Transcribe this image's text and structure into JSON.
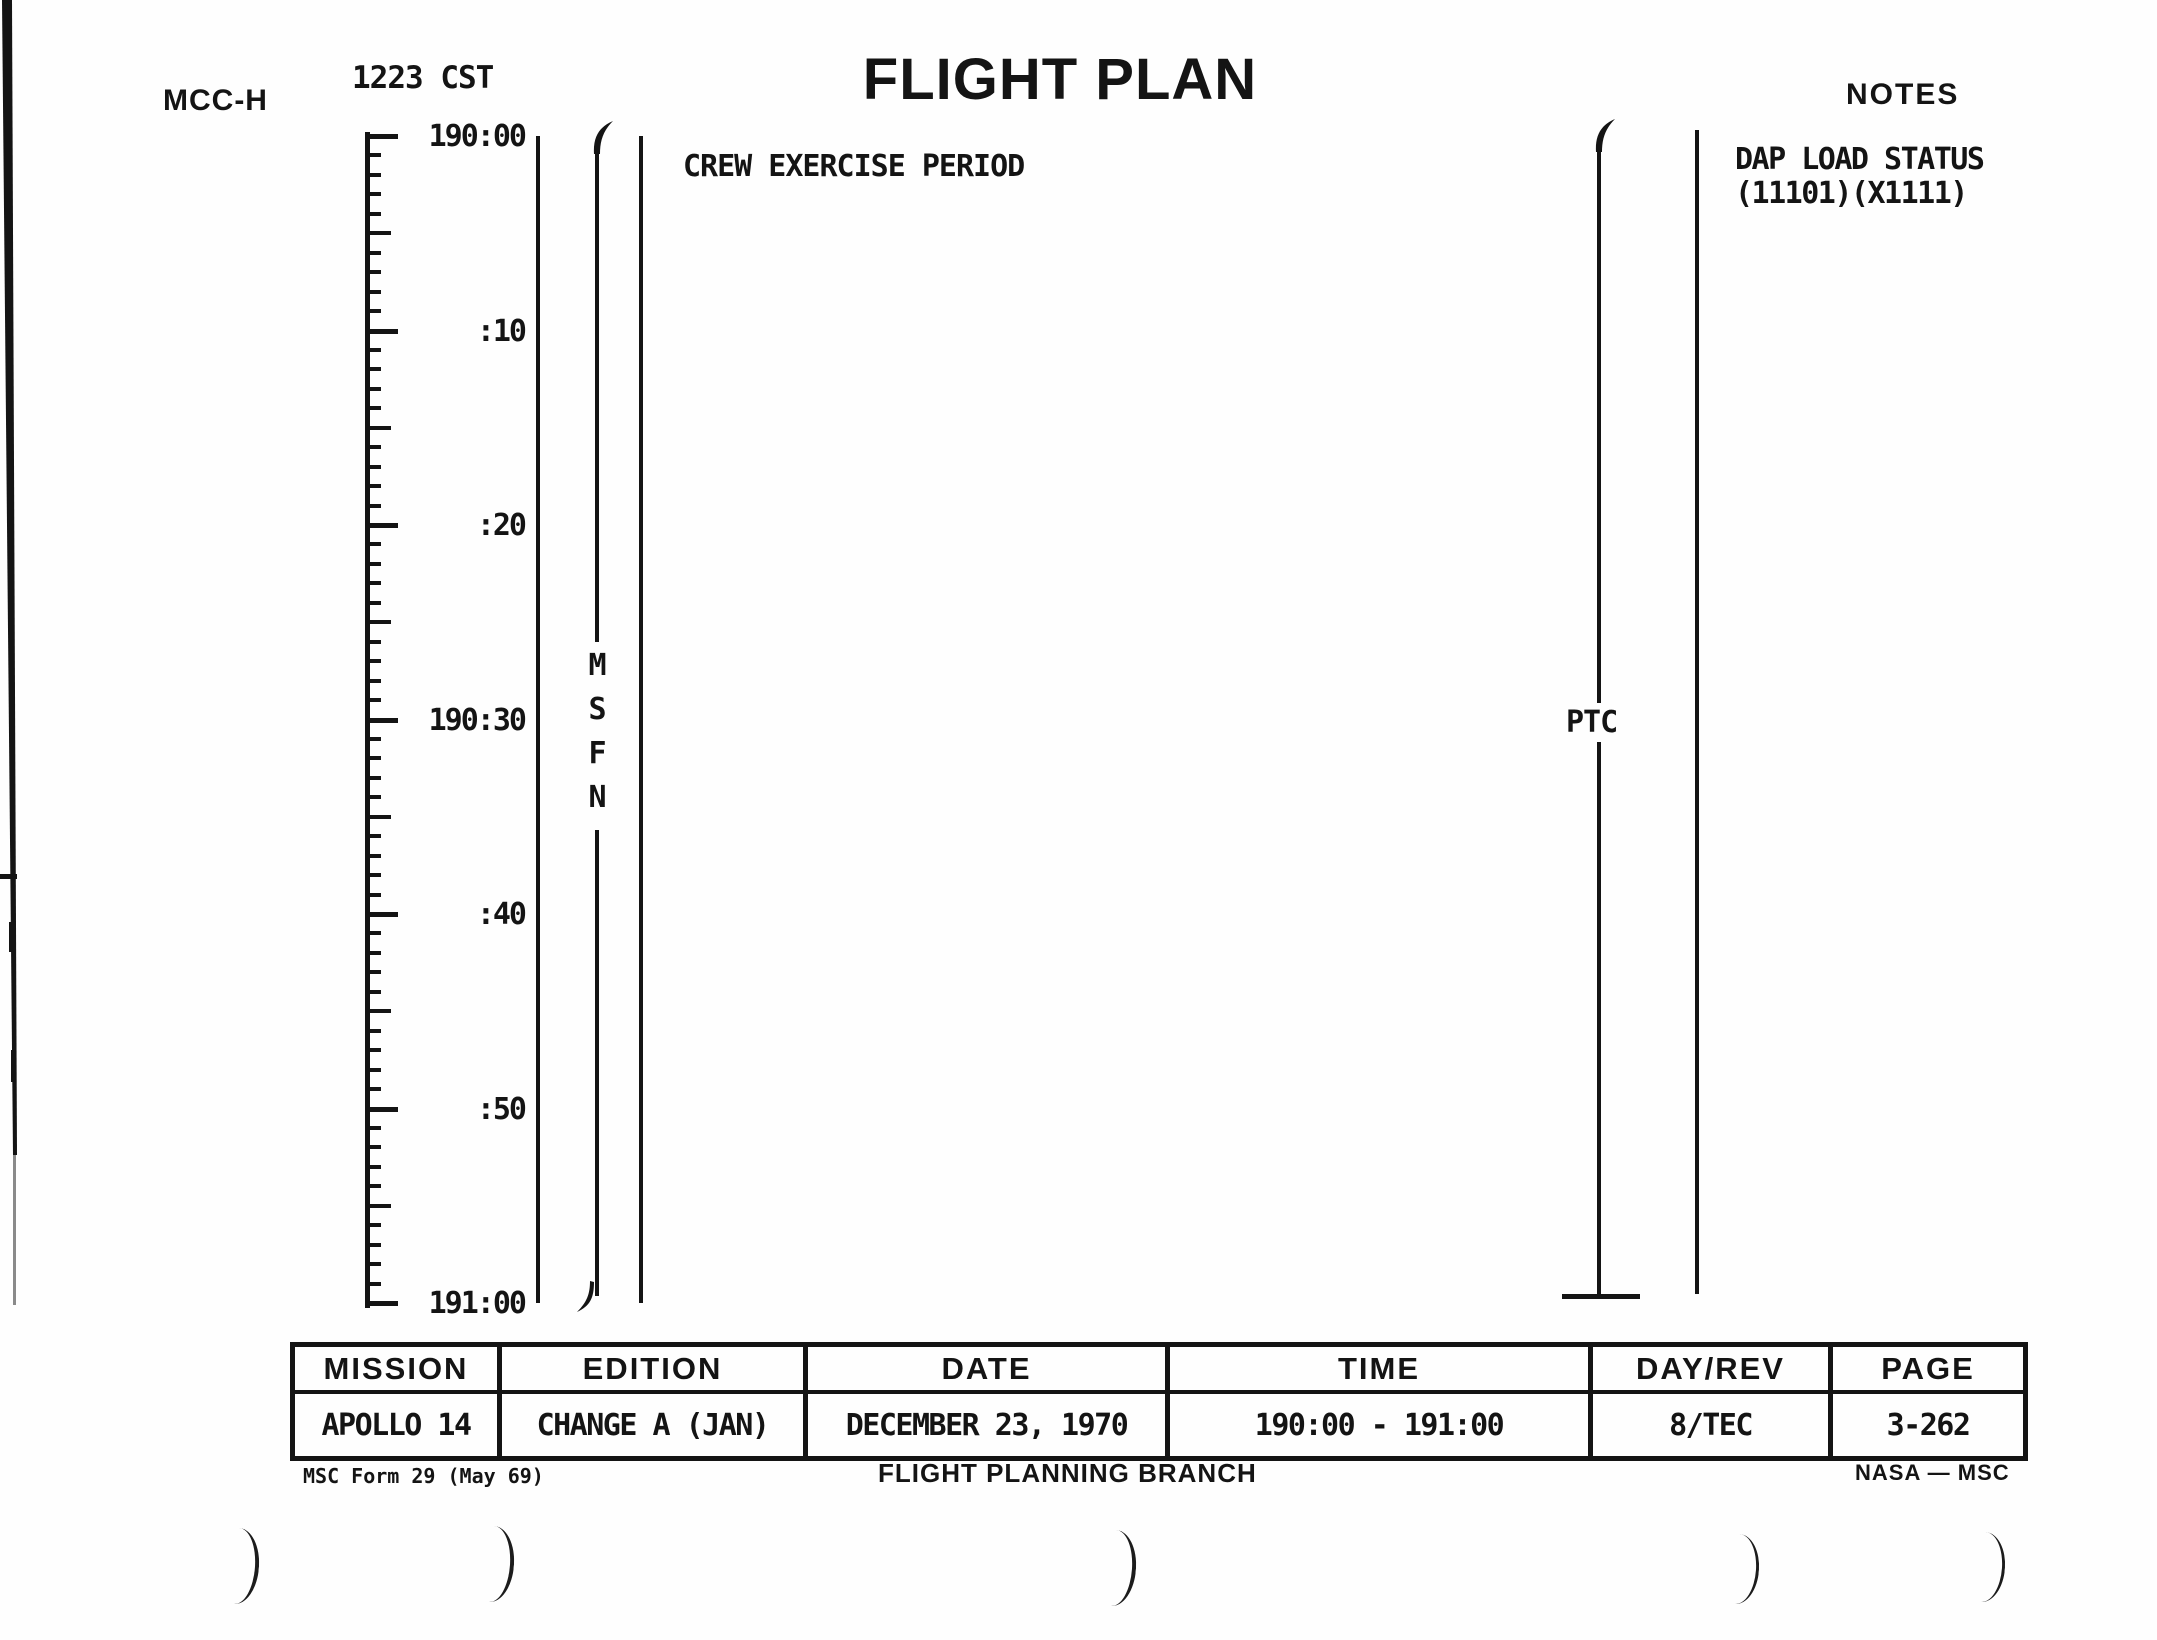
{
  "header": {
    "station": "MCC-H",
    "cst_time": "1223 CST",
    "title": "FLIGHT PLAN",
    "notes_label": "NOTES"
  },
  "timeline": {
    "minutes_total": 60,
    "tick_labels": [
      {
        "label": "190:00",
        "t": 0
      },
      {
        "label": ":10",
        "t": 10
      },
      {
        "label": ":20",
        "t": 20
      },
      {
        "label": "190:30",
        "t": 30
      },
      {
        "label": ":40",
        "t": 40
      },
      {
        "label": ":50",
        "t": 50
      },
      {
        "label": "191:00",
        "t": 60
      }
    ],
    "activity": "CREW EXERCISE PERIOD",
    "msfn_label": "MSFN",
    "ptc_label": "PTC"
  },
  "notes": {
    "line1": "DAP LOAD STATUS",
    "line2": "(11101)(X1111)"
  },
  "footer_table": {
    "columns": [
      "MISSION",
      "EDITION",
      "DATE",
      "TIME",
      "DAY/REV",
      "PAGE"
    ],
    "values": [
      "APOLLO 14",
      "CHANGE A (JAN)",
      "DECEMBER 23, 1970",
      "190:00 - 191:00",
      "8/TEC",
      "3-262"
    ]
  },
  "footer": {
    "form": "MSC Form 29 (May 69)",
    "branch": "FLIGHT PLANNING BRANCH",
    "agency": "NASA — MSC"
  }
}
